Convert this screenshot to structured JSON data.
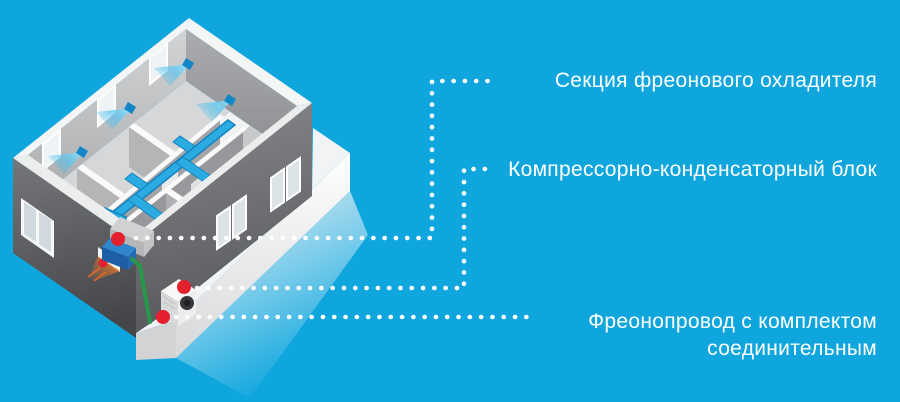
{
  "labels": {
    "cooler_section": "Секция фреонового охладителя",
    "condenser_unit": "Компрессорно-конденсаторный блок",
    "pipeline": "Фреонопровод с комплектом соединительным"
  },
  "colors": {
    "background": "#0fa6de",
    "text": "#ffffff",
    "leader_dots": "#ffffff",
    "marker_red": "#e4202e",
    "duct_blue": "#2aabe2",
    "air_blue": "#8edcf8",
    "cooler_blue_top": "#2f86cd",
    "cooler_blue_front": "#1d5fa6",
    "pipe_green": "#27984a",
    "glow_orange": "#ff7a1e"
  }
}
